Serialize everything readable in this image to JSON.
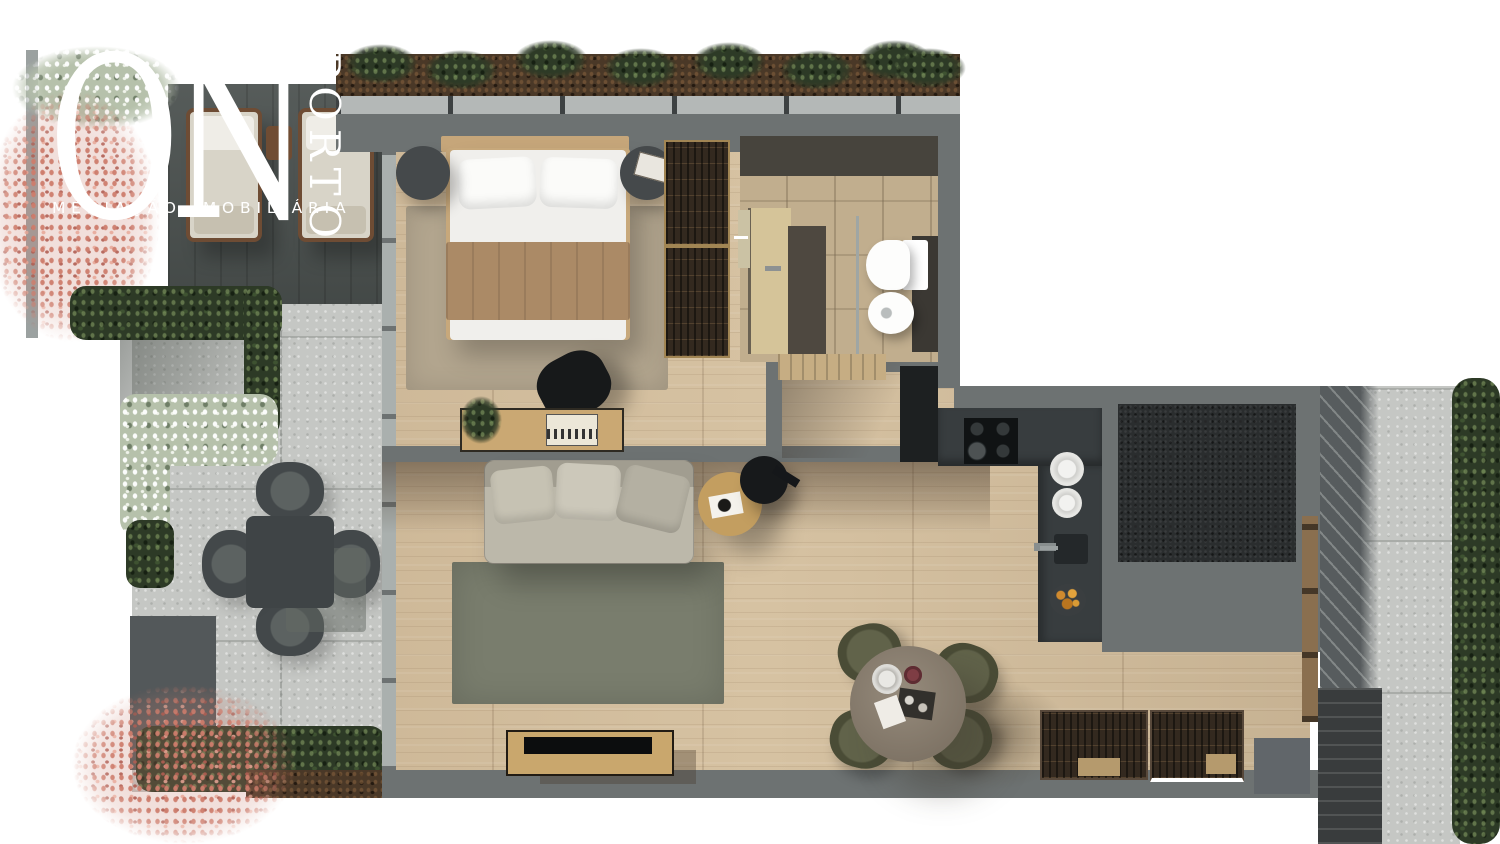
{
  "brand": {
    "name": "ON",
    "city": "PORTO",
    "tagline": "MEDIAÇÃO IMOBILIÁRIA"
  },
  "palette": {
    "brand": "#ffffff",
    "wall": "#6d7272",
    "wood": "#d6c2a2",
    "stone": "#c5c7c4",
    "deck": "#4d5351",
    "hedge": "#2d3a26",
    "counter": "#383d3f",
    "dark_area": "#2a2d2e",
    "rug_living": "#797d6d",
    "rug_bedroom": "#b2a58e",
    "sofa": "#bcb8aa",
    "blanket": "#ab8a66",
    "vanity": "#d5c499",
    "tile": "#c1ae8e",
    "closet": "#33291f",
    "table_wood": "#968b7c",
    "flowers_pink": "#c97f6f",
    "fixture_white": "#fdfdfc"
  },
  "scene": {
    "type": "apartment-floor-plan-render",
    "areas": [
      "terrace-garden-left",
      "bedroom",
      "bathroom",
      "living-room",
      "kitchen",
      "dining-area",
      "terrace-right"
    ]
  }
}
